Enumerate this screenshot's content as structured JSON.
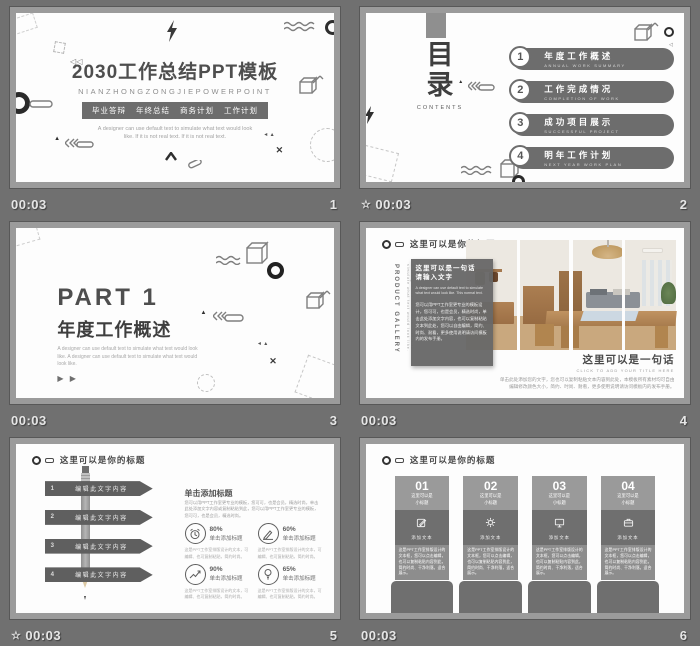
{
  "colors": {
    "canvas_bg": "#707070",
    "frame": "#9b9b9b",
    "slide_bg": "#fdfdfd",
    "dark_gray_accent": "#6d6d6d",
    "meta_text": "#e6e6e6"
  },
  "slides": [
    {
      "number": "1",
      "time": "00:03",
      "title": "2030工作总结PPT模板",
      "subtitle": "NIANZHONGZONGJIEPOWERPOINT",
      "tags": {
        "t1": "毕业答辩",
        "t2": "年终总结",
        "t3": "商务计划",
        "t4": "工作计划"
      },
      "body_line1": "A designer can use default text to simulate what text would look",
      "body_line2": "like. If it is not real text. If it is not real text."
    },
    {
      "number": "2",
      "time": "00:03",
      "star": "☆",
      "toc_char1": "目",
      "toc_char2": "录",
      "toc_sub": "CONTENTS",
      "items": [
        {
          "num": "1",
          "zh": "年度工作概述",
          "en": "ANNUAL WORK SUMMARY"
        },
        {
          "num": "2",
          "zh": "工作完成情况",
          "en": "COMPLETION OF WORK"
        },
        {
          "num": "3",
          "zh": "成功项目展示",
          "en": "SUCCESSFUL PROJECT"
        },
        {
          "num": "4",
          "zh": "明年工作计划",
          "en": "NEXT YEAR WORK PLAN"
        }
      ]
    },
    {
      "number": "3",
      "time": "00:03",
      "part": "PART 1",
      "title": "年度工作概述",
      "body": "A designer can use default text to simulate what text would look like. A designer can use default text to simulate what text would look like.",
      "arrows": "▶ ▶"
    },
    {
      "number": "4",
      "time": "00:03",
      "header": "这里可以是你的标题",
      "vertical_main": "PRODUCT GALLERY",
      "vertical_sub": "A designer can use default text to simulate what text would look like.",
      "overlay_title_l1": "这里可以是一句话",
      "overlay_title_l2": "请输入文字",
      "overlay_en": "A designer can use default text to simulate what text would look like. This normal text.",
      "overlay_zh": "您可以用PPT工作室更专业的模板设计，您可可，也是会员，精选时尚，单击此处添加文字内容，也可以复制粘贴文本到此处，您可以自由编辑，简约、时尚、耐看，更多使用说明请访问模板内的发布手册。",
      "caption_title": "这里可以是一句话",
      "caption_en": "CLICK TO ADD YOUR TITLE HERE",
      "caption_zh": "单击此处添加您的文字，您也可以复制粘贴文本内容到此处，本模板所有素材均可自由编辑修改颜色大小，简约、时尚、耐看，更多使用说明请访问模板内的发布手册。"
    },
    {
      "number": "5",
      "time": "00:03",
      "star": "☆",
      "header": "这里可以是你的标题",
      "banners": [
        {
          "num": "1",
          "label": "编辑此文字内容"
        },
        {
          "num": "2",
          "label": "编辑此文字内容"
        },
        {
          "num": "3",
          "label": "编辑此文字内容"
        },
        {
          "num": "4",
          "label": "编辑此文字内容"
        }
      ],
      "right_heading": "单击添加标题",
      "right_para": "您可以用PPT工作室更专业的模板，您可可，也是会员，精选时尚，单击此处添加文字内容或复制粘贴到此，您可以用PPT工作室更专业的模板，您可可，也是会员，精选时尚。",
      "stats": [
        {
          "icon": "alarm-clock-icon",
          "pct": "80%",
          "label": "单击添加标题",
          "desc": "这是PPT工作室排版设计的文本，可编辑、也可复制粘贴，简约时尚。"
        },
        {
          "icon": "writing-hand-icon",
          "pct": "60%",
          "label": "单击添加标题",
          "desc": "这是PPT工作室排版设计的文本，可编辑、也可复制粘贴，简约时尚。"
        },
        {
          "icon": "growth-chart-icon",
          "pct": "90%",
          "label": "单击添加标题",
          "desc": "这是PPT工作室排版设计的文本，可编辑、也可复制粘贴，简约时尚。"
        },
        {
          "icon": "light-bulb-icon",
          "pct": "65%",
          "label": "单击添加标题",
          "desc": "这是PPT工作室排版设计的文本，可编辑、也可复制粘贴，简约时尚。"
        }
      ]
    },
    {
      "number": "6",
      "time": "00:03",
      "header": "这里可以是你的标题",
      "columns": [
        {
          "num": "01",
          "sub_l1": "这里可以是",
          "sub_l2": "小标题",
          "icon": "edit-icon",
          "icon_label": "添加文本",
          "para": "这是PPT工作室排版设计的文本框，您可以点击编辑，也可以复制粘贴内容到此，简约时尚、干净利落，适合展示。"
        },
        {
          "num": "02",
          "sub_l1": "这里可以是",
          "sub_l2": "小标题",
          "icon": "gear-icon",
          "icon_label": "添加文本",
          "para": "这是PPT工作室排版设计的文本框，您可以点击编辑，也可以复制粘贴内容到此，简约时尚、干净利落，适合展示。"
        },
        {
          "num": "03",
          "sub_l1": "这里可以是",
          "sub_l2": "小标题",
          "icon": "monitor-icon",
          "icon_label": "添加文本",
          "para": "这是PPT工作室排版设计的文本框，您可以点击编辑，也可以复制粘贴内容到此，简约时尚、干净利落，适合展示。"
        },
        {
          "num": "04",
          "sub_l1": "这里可以是",
          "sub_l2": "小标题",
          "icon": "briefcase-icon",
          "icon_label": "添加文本",
          "para": "这是PPT工作室排版设计的文本框，您可以点击编辑，也可以复制粘贴内容到此，简约时尚、干净利落，适合展示。"
        }
      ]
    }
  ]
}
